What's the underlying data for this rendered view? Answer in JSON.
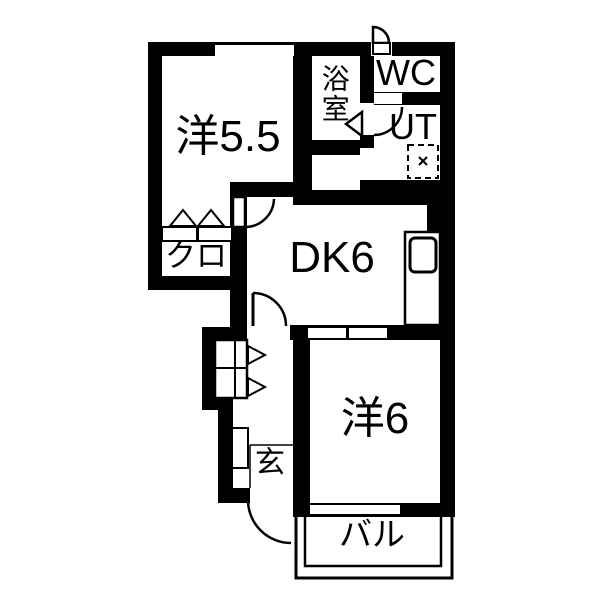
{
  "title": "apartment-floor-plan",
  "rooms": {
    "western_room_55": {
      "label": "洋5.5",
      "type": "western-style room 5.5 tatami"
    },
    "bathroom": {
      "label": "浴室",
      "type": "bath room"
    },
    "toilet": {
      "label": "WC",
      "type": "toilet"
    },
    "utility": {
      "label": "UT",
      "type": "utility / washer space"
    },
    "dining_kitchen": {
      "label": "DK6",
      "type": "dining kitchen 6 tatami"
    },
    "closet": {
      "label": "クロ",
      "type": "closet"
    },
    "entrance": {
      "label": "玄",
      "type": "entrance (genkan)"
    },
    "western_room_6": {
      "label": "洋6",
      "type": "western-style room 6 tatami"
    },
    "balcony": {
      "label": "バル",
      "type": "balcony"
    }
  },
  "colors": {
    "wall": "#000000",
    "background": "#ffffff",
    "text": "#000000"
  }
}
